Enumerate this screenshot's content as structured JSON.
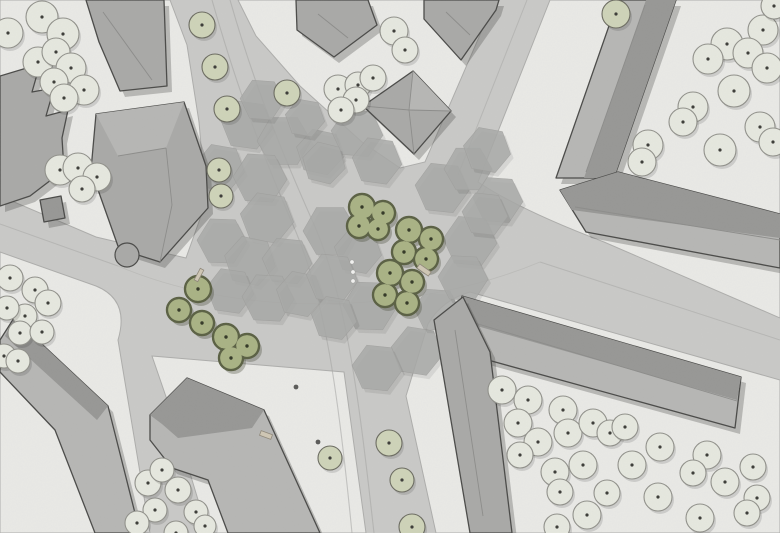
{
  "canvas": {
    "width": 780,
    "height": 533
  },
  "colors": {
    "road": "#c9c9c7",
    "block": "#e9e9e6",
    "block_stroke": "#adadab",
    "hex": "#a9aaa8",
    "hex_stroke": "#9e9e9c",
    "lane": "#a3a3a1",
    "building_mid": "#a9a9a7",
    "building_light": "#b6b6b4",
    "building_dark": "#979795",
    "building_stroke": "#4a4a48",
    "ridge": "#8c8c8a",
    "shadow": "rgba(70,70,66,0.30)",
    "tree_fill": "#e6e8df",
    "tree_stroke": "#90908a",
    "tree_dot": "#3c3c38",
    "sage_fill": "#ced3b8",
    "sage_stroke": "#6b6b60",
    "green_fill": "#a9b284",
    "green_stroke": "#5a6043",
    "green_dot": "#333826",
    "bench": "#cfc7b4",
    "bench_stroke": "#8f887a",
    "bed_stroke": "#9a9a92"
  },
  "blocks": [
    {
      "name": "block-northwest",
      "d": "M0,0 L170,0 L187,45 L199,122 L206,202 L186,258 L96,237 L0,196 Z"
    },
    {
      "name": "block-north-center",
      "d": "M238,0 L495,0 L425,162 L400,168 L362,142 L300,86 L256,36 Z"
    },
    {
      "name": "block-northeast",
      "d": "M550,0 L780,0 L780,318 L604,242 Q520,210 478,182 Z"
    },
    {
      "name": "block-southeast",
      "d": "M406,396 L428,324 Q442,300 470,292 L780,380 L780,533 L436,533 Z"
    },
    {
      "name": "block-south-center",
      "d": "M152,356 L344,372 L366,533 L208,533 L174,420 Z"
    },
    {
      "name": "block-southwest",
      "d": "M0,252 L96,286 Q130,300 118,340 L150,533 L0,533 Z"
    }
  ],
  "lane_lines": [
    {
      "d": "M212,0 C232,70 252,130 293,225 C325,298 338,390 352,533",
      "w": 1.1,
      "o": 0.55
    },
    {
      "d": "M230,0 C250,70 272,130 312,220 C346,295 358,390 374,533",
      "w": 1.1,
      "o": 0.55
    },
    {
      "d": "M0,224 L118,266",
      "w": 1.0,
      "o": 0.5
    },
    {
      "d": "M540,262 L780,340",
      "w": 1.0,
      "o": 0.5
    },
    {
      "d": "M527,0 L458,175",
      "w": 1.0,
      "o": 0.5
    },
    {
      "d": "M118,266 C250,322 420,312 540,262",
      "w": 0.9,
      "o": 0.35
    }
  ],
  "hexagons": [
    [
      247,
      125,
      26,
      8
    ],
    [
      284,
      141,
      27,
      0
    ],
    [
      320,
      152,
      24,
      12
    ],
    [
      357,
      133,
      26,
      5
    ],
    [
      220,
      168,
      25,
      10
    ],
    [
      260,
      178,
      27,
      3
    ],
    [
      324,
      163,
      22,
      14
    ],
    [
      377,
      161,
      25,
      8
    ],
    [
      442,
      188,
      27,
      6
    ],
    [
      468,
      169,
      24,
      0
    ],
    [
      487,
      150,
      24,
      10
    ],
    [
      498,
      200,
      25,
      4
    ],
    [
      267,
      218,
      27,
      9
    ],
    [
      222,
      241,
      25,
      2
    ],
    [
      250,
      261,
      26,
      12
    ],
    [
      287,
      261,
      25,
      6
    ],
    [
      330,
      231,
      27,
      0
    ],
    [
      358,
      251,
      24,
      10
    ],
    [
      470,
      241,
      27,
      5
    ],
    [
      230,
      291,
      24,
      8
    ],
    [
      268,
      298,
      26,
      3
    ],
    [
      300,
      294,
      24,
      11
    ],
    [
      332,
      278,
      26,
      7
    ],
    [
      370,
      306,
      27,
      2
    ],
    [
      417,
      351,
      26,
      9
    ],
    [
      437,
      310,
      23,
      4
    ],
    [
      377,
      368,
      25,
      6
    ],
    [
      334,
      318,
      23,
      10
    ],
    [
      463,
      278,
      25,
      3
    ],
    [
      485,
      214,
      23,
      6
    ],
    [
      262,
      100,
      22,
      4
    ],
    [
      305,
      118,
      20,
      10
    ]
  ],
  "buildings": [
    {
      "name": "building-nw-top",
      "tone": "building_mid",
      "points": [
        [
          86,
          0
        ],
        [
          164,
          0
        ],
        [
          167,
          86
        ],
        [
          120,
          91
        ],
        [
          99,
          42
        ]
      ],
      "ridges": [
        [
          103,
          12,
          152,
          80
        ]
      ]
    },
    {
      "name": "building-nw-west-row",
      "tone": "building_mid",
      "points": [
        [
          0,
          76
        ],
        [
          40,
          64
        ],
        [
          32,
          92
        ],
        [
          54,
          88
        ],
        [
          46,
          116
        ],
        [
          68,
          110
        ],
        [
          62,
          138
        ],
        [
          64,
          170
        ],
        [
          30,
          196
        ],
        [
          0,
          206
        ]
      ]
    },
    {
      "name": "building-nw-corner-villa",
      "tone": "building_mid",
      "points": [
        [
          96,
          114
        ],
        [
          184,
          102
        ],
        [
          206,
          166
        ],
        [
          208,
          208
        ],
        [
          160,
          262
        ],
        [
          119,
          249
        ],
        [
          91,
          170
        ]
      ],
      "facet": {
        "tone": "building_light",
        "points": [
          [
            96,
            114
          ],
          [
            184,
            102
          ],
          [
            166,
            148
          ],
          [
            118,
            156
          ]
        ]
      },
      "ridges": [
        [
          118,
          156,
          166,
          148
        ],
        [
          166,
          148,
          172,
          205
        ],
        [
          172,
          205,
          160,
          262
        ]
      ],
      "circles": [
        [
          127,
          255,
          12
        ]
      ]
    },
    {
      "name": "building-nw-shed",
      "tone": "building_dark",
      "points": [
        [
          40,
          200
        ],
        [
          61,
          196
        ],
        [
          65,
          218
        ],
        [
          44,
          222
        ]
      ]
    },
    {
      "name": "building-north-gable-west",
      "tone": "building_mid",
      "points": [
        [
          296,
          0
        ],
        [
          368,
          0
        ],
        [
          377,
          25
        ],
        [
          334,
          57
        ],
        [
          297,
          30
        ]
      ],
      "ridges": [
        [
          318,
          14,
          348,
          38
        ]
      ]
    },
    {
      "name": "building-north-gable-east",
      "tone": "building_mid",
      "points": [
        [
          424,
          0
        ],
        [
          499,
          0
        ],
        [
          496,
          10
        ],
        [
          461,
          60
        ],
        [
          424,
          19
        ]
      ],
      "ridges": [
        [
          446,
          12,
          470,
          35
        ]
      ]
    },
    {
      "name": "building-north-pavilion",
      "tone": "building_mid",
      "points": [
        [
          413,
          71
        ],
        [
          451,
          111
        ],
        [
          414,
          154
        ],
        [
          363,
          106
        ]
      ],
      "facet": {
        "tone": "building_light",
        "points": [
          [
            413,
            71
          ],
          [
            451,
            111
          ],
          [
            409,
            110
          ]
        ]
      },
      "ridges": [
        [
          409,
          110,
          413,
          71
        ],
        [
          409,
          110,
          451,
          111
        ],
        [
          409,
          110,
          414,
          154
        ],
        [
          409,
          110,
          363,
          106
        ]
      ]
    },
    {
      "name": "building-ne-slab",
      "tone": "building_light",
      "points": [
        [
          618,
          0
        ],
        [
          676,
          0
        ],
        [
          614,
          178
        ],
        [
          556,
          178
        ]
      ],
      "facet": {
        "tone": "building_dark",
        "points": [
          [
            646,
            0
          ],
          [
            676,
            0
          ],
          [
            614,
            178
          ],
          [
            584,
            178
          ]
        ]
      },
      "ridges": [
        [
          645,
          5,
          586,
          172
        ]
      ]
    },
    {
      "name": "building-ne-south-wing",
      "tone": "building_light",
      "points": [
        [
          560,
          190
        ],
        [
          618,
          172
        ],
        [
          780,
          214
        ],
        [
          780,
          268
        ],
        [
          586,
          232
        ]
      ],
      "facet": {
        "tone": "building_dark",
        "points": [
          [
            560,
            190
          ],
          [
            618,
            172
          ],
          [
            780,
            214
          ],
          [
            780,
            238
          ],
          [
            572,
            210
          ]
        ]
      },
      "ridges": [
        [
          575,
          207,
          780,
          240
        ]
      ]
    },
    {
      "name": "building-se-long-wing",
      "tone": "building_light",
      "points": [
        [
          462,
          296
        ],
        [
          741,
          377
        ],
        [
          735,
          428
        ],
        [
          448,
          349
        ]
      ],
      "facet": {
        "tone": "building_dark",
        "points": [
          [
            462,
            296
          ],
          [
            741,
            377
          ],
          [
            737,
            400
          ],
          [
            456,
            320
          ]
        ]
      },
      "ridges": [
        [
          458,
          318,
          737,
          401
        ]
      ]
    },
    {
      "name": "building-se-street-wing",
      "tone": "building_mid",
      "points": [
        [
          434,
          320
        ],
        [
          463,
          297
        ],
        [
          490,
          352
        ],
        [
          512,
          533
        ],
        [
          470,
          533
        ]
      ],
      "ridges": [
        [
          455,
          330,
          483,
          516
        ]
      ]
    },
    {
      "name": "building-south-courtyard",
      "tone": "building_light",
      "points": [
        [
          150,
          415
        ],
        [
          187,
          378
        ],
        [
          264,
          410
        ],
        [
          320,
          533
        ],
        [
          228,
          533
        ],
        [
          208,
          480
        ],
        [
          172,
          468
        ],
        [
          150,
          440
        ]
      ],
      "facet": {
        "tone": "building_dark",
        "points": [
          [
            150,
            415
          ],
          [
            187,
            378
          ],
          [
            264,
            410
          ],
          [
            252,
            428
          ],
          [
            178,
            438
          ],
          [
            162,
            424
          ]
        ]
      }
    },
    {
      "name": "building-sw-slab",
      "tone": "building_light",
      "points": [
        [
          14,
          318
        ],
        [
          108,
          406
        ],
        [
          140,
          533
        ],
        [
          95,
          533
        ],
        [
          55,
          430
        ],
        [
          0,
          372
        ],
        [
          0,
          340
        ]
      ],
      "facet": {
        "tone": "building_dark",
        "points": [
          [
            14,
            318
          ],
          [
            108,
            406
          ],
          [
            97,
            420
          ],
          [
            5,
            336
          ]
        ]
      }
    }
  ],
  "trees_courtyard": [
    [
      42,
      17,
      16
    ],
    [
      8,
      33,
      15
    ],
    [
      63,
      34,
      16
    ],
    [
      38,
      62,
      15
    ],
    [
      56,
      52,
      14
    ],
    [
      71,
      68,
      15
    ],
    [
      54,
      82,
      14
    ],
    [
      84,
      90,
      15
    ],
    [
      64,
      98,
      14
    ],
    [
      60,
      170,
      15
    ],
    [
      78,
      168,
      15
    ],
    [
      97,
      177,
      14
    ],
    [
      82,
      189,
      13
    ],
    [
      394,
      31,
      14
    ],
    [
      405,
      50,
      13
    ],
    [
      338,
      89,
      14
    ],
    [
      358,
      85,
      13
    ],
    [
      373,
      78,
      13
    ],
    [
      356,
      100,
      13
    ],
    [
      341,
      110,
      13
    ],
    [
      763,
      30,
      15
    ],
    [
      727,
      44,
      16
    ],
    [
      748,
      53,
      15
    ],
    [
      708,
      59,
      15
    ],
    [
      767,
      68,
      15
    ],
    [
      734,
      91,
      16
    ],
    [
      693,
      107,
      15
    ],
    [
      683,
      122,
      14
    ],
    [
      760,
      127,
      15
    ],
    [
      773,
      142,
      14
    ],
    [
      720,
      150,
      16
    ],
    [
      648,
      145,
      15
    ],
    [
      642,
      162,
      14
    ],
    [
      774,
      6,
      13
    ],
    [
      502,
      390,
      14
    ],
    [
      528,
      400,
      14
    ],
    [
      518,
      423,
      14
    ],
    [
      563,
      410,
      14
    ],
    [
      568,
      433,
      14
    ],
    [
      593,
      423,
      14
    ],
    [
      610,
      433,
      13
    ],
    [
      625,
      427,
      13
    ],
    [
      660,
      447,
      14
    ],
    [
      538,
      442,
      14
    ],
    [
      520,
      455,
      13
    ],
    [
      555,
      472,
      14
    ],
    [
      560,
      492,
      13
    ],
    [
      583,
      465,
      14
    ],
    [
      632,
      465,
      14
    ],
    [
      658,
      497,
      14
    ],
    [
      707,
      455,
      14
    ],
    [
      693,
      473,
      13
    ],
    [
      725,
      482,
      14
    ],
    [
      753,
      467,
      13
    ],
    [
      757,
      498,
      13
    ],
    [
      607,
      493,
      13
    ],
    [
      587,
      515,
      14
    ],
    [
      557,
      527,
      13
    ],
    [
      700,
      518,
      14
    ],
    [
      747,
      513,
      13
    ],
    [
      10,
      278,
      13
    ],
    [
      35,
      290,
      13
    ],
    [
      48,
      303,
      13
    ],
    [
      25,
      316,
      12
    ],
    [
      7,
      308,
      12
    ],
    [
      20,
      333,
      12
    ],
    [
      42,
      332,
      12
    ],
    [
      4,
      356,
      12
    ],
    [
      18,
      361,
      12
    ],
    [
      148,
      483,
      13
    ],
    [
      162,
      470,
      12
    ],
    [
      178,
      490,
      13
    ],
    [
      155,
      510,
      12
    ],
    [
      137,
      523,
      12
    ],
    [
      196,
      512,
      12
    ],
    [
      205,
      526,
      11
    ],
    [
      176,
      533,
      12
    ]
  ],
  "trees_street": [
    [
      202,
      25,
      13
    ],
    [
      215,
      67,
      13
    ],
    [
      227,
      109,
      13
    ],
    [
      219,
      170,
      12
    ],
    [
      221,
      196,
      12
    ],
    [
      287,
      93,
      13
    ],
    [
      616,
      14,
      14
    ],
    [
      330,
      458,
      12
    ],
    [
      389,
      443,
      13
    ],
    [
      402,
      480,
      12
    ],
    [
      412,
      527,
      13
    ]
  ],
  "tree_beds": [
    {
      "x": 287,
      "y": 93,
      "s": 16,
      "rot": 22
    },
    {
      "x": 616,
      "y": 14,
      "s": 16,
      "rot": -20
    },
    {
      "x": 219,
      "y": 170,
      "s": 15,
      "rot": 22
    },
    {
      "x": 221,
      "y": 196,
      "s": 15,
      "rot": 22
    }
  ],
  "green_clusters": [
    {
      "circles": [
        [
          198,
          289,
          13
        ],
        [
          179,
          310,
          12
        ],
        [
          202,
          323,
          12
        ]
      ]
    },
    {
      "circles": [
        [
          226,
          337,
          13
        ],
        [
          247,
          346,
          12
        ],
        [
          231,
          358,
          12
        ]
      ]
    },
    {
      "circles": [
        [
          362,
          207,
          13
        ],
        [
          383,
          213,
          12
        ],
        [
          359,
          226,
          12
        ],
        [
          378,
          229,
          11
        ]
      ]
    },
    {
      "circles": [
        [
          409,
          230,
          13
        ],
        [
          431,
          239,
          12
        ],
        [
          404,
          252,
          12
        ],
        [
          426,
          259,
          12
        ]
      ]
    },
    {
      "circles": [
        [
          390,
          273,
          13
        ],
        [
          412,
          282,
          12
        ],
        [
          385,
          295,
          12
        ],
        [
          407,
          303,
          12
        ]
      ]
    }
  ],
  "benches": [
    {
      "x": 424,
      "y": 270,
      "w": 14,
      "h": 5,
      "rot": 35
    },
    {
      "x": 266,
      "y": 435,
      "w": 12,
      "h": 5,
      "rot": 20
    },
    {
      "x": 199,
      "y": 275,
      "w": 13,
      "h": 4,
      "rot": 118
    }
  ],
  "white_dots": [
    [
      352,
      262
    ],
    [
      353,
      272
    ],
    [
      353,
      281
    ]
  ],
  "dark_dots": [
    [
      318,
      442
    ],
    [
      296,
      387
    ]
  ]
}
